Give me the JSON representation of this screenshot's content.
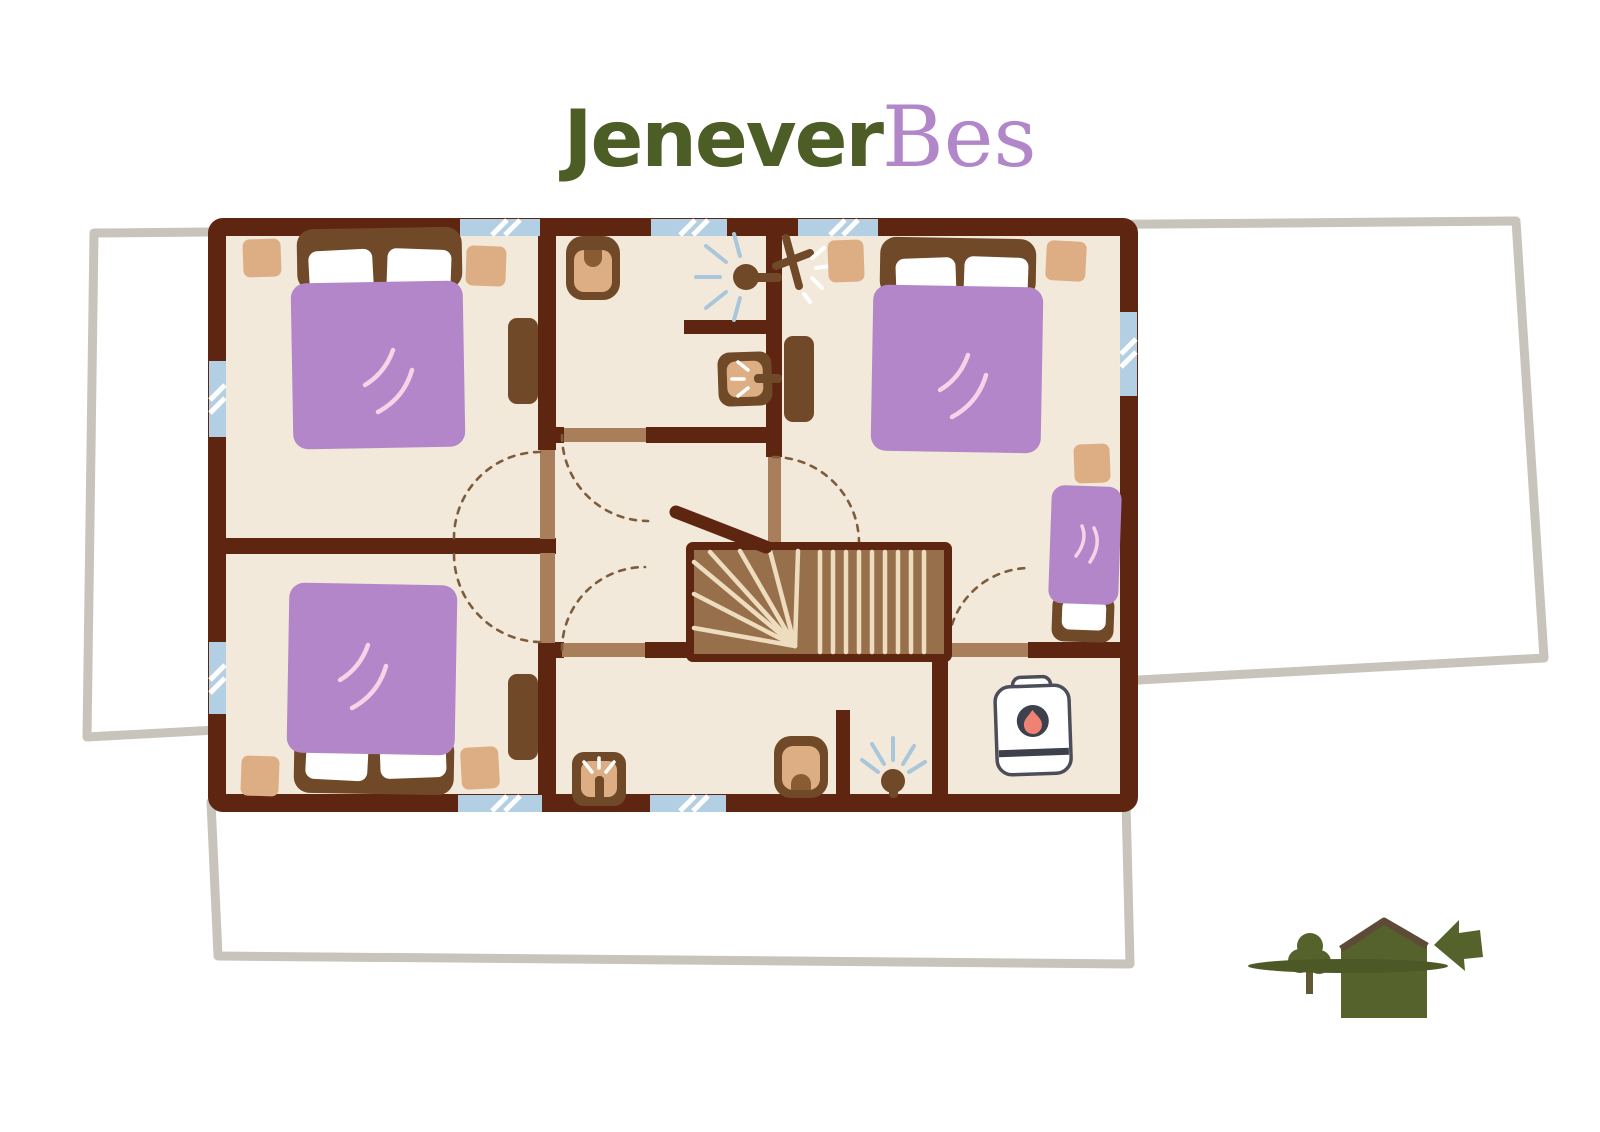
{
  "logo": {
    "text_green": "Jenever",
    "text_purple": "Bes"
  },
  "palette": {
    "wall": "#5e2511",
    "floor": "#f3e9da",
    "furniture_brown": "#6f4928",
    "blanket_purple": "#b286c9",
    "nightstand_tan": "#ddae84",
    "door_tan": "#a87e5b",
    "stairs_brown": "#97704b",
    "stair_tread_cream": "#eedcbf",
    "window_blue": "#b3cfe3",
    "ground_outline_gray": "#c8c4bb",
    "logo_green": "#4c5d26",
    "logo_purple": "#b287c9",
    "house_icon_green": "#55622c",
    "boiler_dark": "#3e414b",
    "flame_red": "#ef8272",
    "spray_blue": "#a9c6db",
    "swing_dash_brown": "#7d5c3c",
    "blanket_stroke_pink": "#f6d4e8"
  },
  "icons": [
    "double-bed",
    "single-bed",
    "pillow",
    "nightstand",
    "dresser",
    "toilet",
    "sink",
    "shower-head",
    "sparkle-light",
    "staircase",
    "handrail",
    "boiler",
    "flame",
    "window",
    "door-leaf",
    "door-swing-arc",
    "ground-floor-outline",
    "house-icon",
    "tree-icon",
    "arrow-left-icon"
  ]
}
